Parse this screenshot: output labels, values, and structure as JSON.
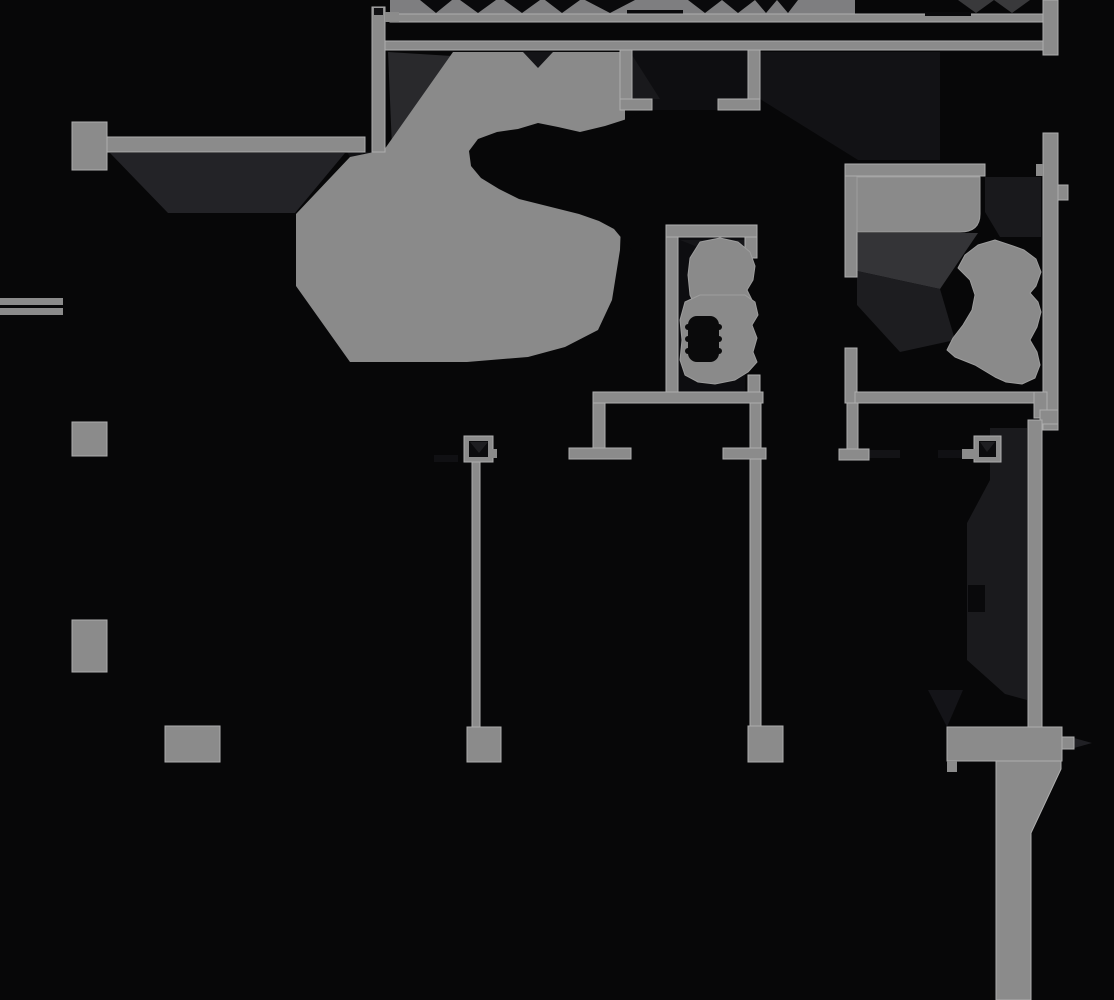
{
  "meta": {
    "kind": "architectural-floor-plan",
    "style": "dark CAD plan, black background with gray walls and fixtures",
    "visible_text": "none"
  },
  "palette": {
    "bg": "#070708",
    "wall": "#8b8b8b",
    "wall-edge": "#aeaeae",
    "fixture": "#8a8a8a",
    "fix-edge": "#9d9d9d",
    "hole": "#0a0a0b",
    "sh1": "#343437",
    "sh2": "#232327",
    "sh3": "#1a1a1d",
    "sh4": "#121215",
    "sh5": "#0d0d10",
    "notch": "#141417",
    "tri-dark": "#39393b"
  },
  "floorplan": {
    "rooms": [
      {
        "name": "stair-hall",
        "fixtures": [
          "spiral-stair-mass"
        ]
      },
      {
        "name": "wc",
        "fixtures": [
          "toilet"
        ]
      },
      {
        "name": "bathroom",
        "fixtures": [
          "bathtub",
          "vanity-sink"
        ]
      }
    ],
    "structure": {
      "columns_solid": 5,
      "columns_hollow": 2,
      "wall-end-tees": 3,
      "section-cut-band": "sawtooth strip along top edge",
      "tapered-pier": "bottom-right with header beam"
    }
  }
}
